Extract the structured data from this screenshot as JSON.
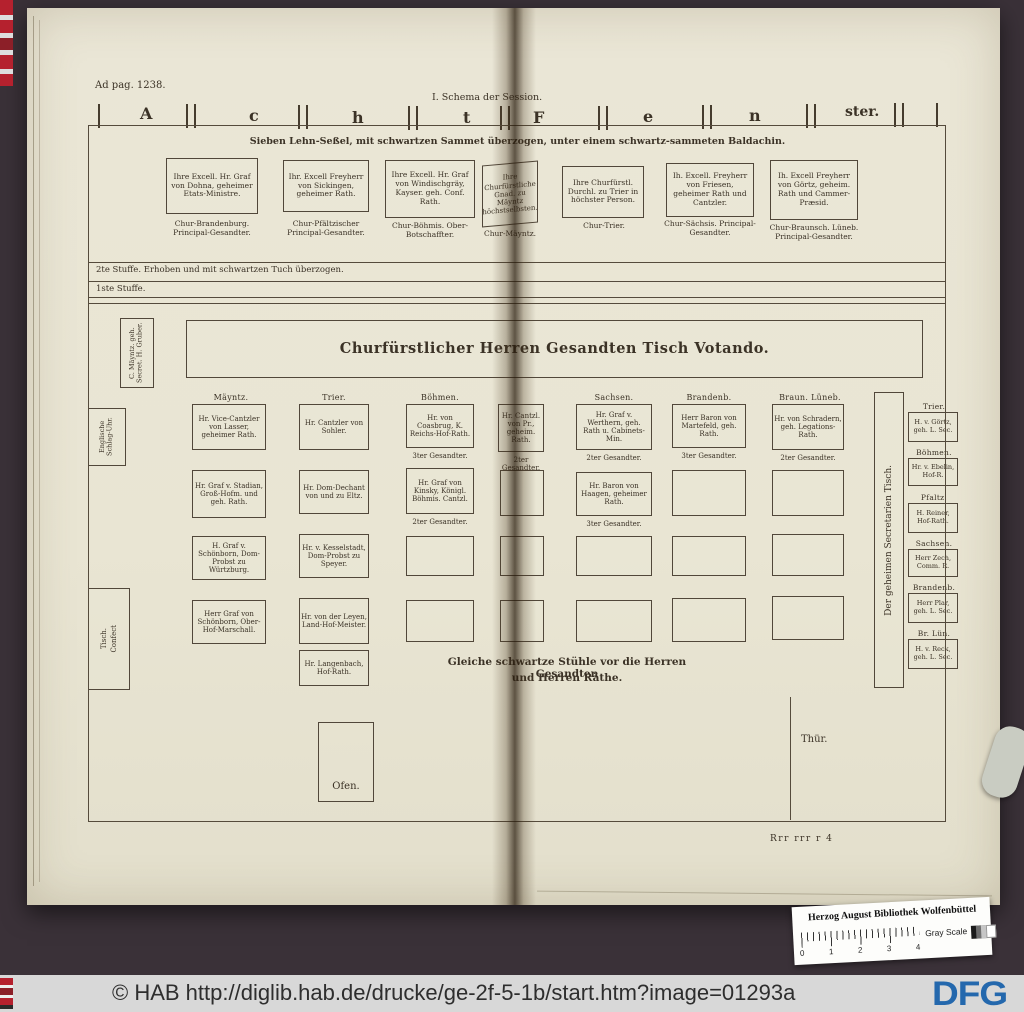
{
  "colors": {
    "page_bg": "#e9e5d3",
    "ink": "#3b3226",
    "backdrop": "#3a3138",
    "bar_bg": "#d8d8d8",
    "dfg_blue": "#2468ad",
    "strip_red": "#b5212e"
  },
  "scan": {
    "ad_pag": "Ad pag. 1238.",
    "schema_label": "I. Schema der Session.",
    "window_letters": [
      "A",
      "c",
      "h",
      "t",
      "F",
      "e",
      "n",
      "ster."
    ],
    "baldachin_caption": "Sieben Lehn-Seßel, mit schwartzen Sammet überzogen, unter einem schwartz-sammeten Baldachin.",
    "chairs": [
      {
        "box": "Ihre Excell. Hr. Graf von Dohna, geheimer Etats-Ministre.",
        "caption": "Chur-Brandenburg. Principal-Gesandter."
      },
      {
        "box": "Ihr. Excell Freyherr von Sickingen, geheimer Rath.",
        "caption": "Chur-Pfältzischer Principal-Gesandter."
      },
      {
        "box": "Ihre Excell. Hr. Graf von Windischgräy, Kayser. geh. Conf. Rath.",
        "caption": "Chur-Böhmis. Ober-Botschaffter."
      },
      {
        "box": "Ihre Churfürstliche Gnad. zu Mäyntz höchstselbsten.",
        "caption": "Chur-Mäyntz."
      },
      {
        "box": "Ihre Churfürstl. Durchl. zu Trier in höchster Person.",
        "caption": "Chur-Trier."
      },
      {
        "box": "Ih. Excell. Freyherr von Friesen, geheimer Rath und Cantzler.",
        "caption": "Chur-Sächsis. Principal-Gesandter."
      },
      {
        "box": "Ih. Excell Freyherr von Görtz, geheim. Rath und Cammer-Præsid.",
        "caption": "Chur-Braunsch. Lüneb. Principal-Gesandter."
      }
    ],
    "steps": {
      "step2": "2te Stuffe. Erhoben und mit schwartzen Tuch überzogen.",
      "step1": "1ste Stuffe."
    },
    "left_secretary": "C. Mäyntz. geh. Secret. H. Gruber.",
    "table_title": "Churfürstlicher Herren Gesandten Tisch Votando.",
    "clock": "Englische Schlag-Uhr.",
    "columns": {
      "mayntz": "Mäyntz.",
      "trier": "Trier.",
      "boehmen": "Böhmen.",
      "sachsen": "Sachsen.",
      "brandenb": "Brandenb.",
      "braun": "Braun. Lüneb."
    },
    "seats": {
      "m1": {
        "text": "Hr. Vice-Cantzler von Lasser, geheimer Rath."
      },
      "m2": {
        "text": "Hr. Graf v. Stadian, Groß-Hofm. und geh. Rath."
      },
      "m3": {
        "text": "H. Graf v. Schönborn, Dom-Probst zu Würtzburg."
      },
      "m4": {
        "text": "Herr Graf von Schönborn, Ober-Hof-Marschall."
      },
      "t1": {
        "text": "Hr. Cantzler von Sohler."
      },
      "t2": {
        "text": "Hr. Dom-Dechant von und zu Eltz."
      },
      "t3": {
        "text": "Hr. v. Kesselstadt, Dom-Probst zu Speyer."
      },
      "t4": {
        "text": "Hr. von der Leyen, Land-Hof-Meister."
      },
      "t5": {
        "text": "Hr. Langenbach, Hof-Rath."
      },
      "b1": {
        "text": "Hr. von Coasbrug, K. Reichs-Hof-Rath.",
        "sub": "3ter Gesandter."
      },
      "b2": {
        "text": "Hr. Graf von Kinsky, Königl. Böhmis. Cantzl.",
        "sub": "2ter Gesandter."
      },
      "f1": {
        "text": "Hr. Cantzl. von Pr., geheim. Rath.",
        "sub": "2ter Gesandter."
      },
      "s1": {
        "text": "Hr. Graf v. Werthern, geh. Rath u. Cabinets-Min.",
        "sub": "2ter Gesandter."
      },
      "s2": {
        "text": "Hr. Baron von Haagen, geheimer Rath.",
        "sub": "3ter Gesandter."
      },
      "br1": {
        "text": "Herr Baron von Martefeld, geh. Rath.",
        "sub": "3ter Gesandter."
      },
      "bl1": {
        "text": "Hr. von Schradern, geh. Legations-Rath.",
        "sub": "2ter Gesandter."
      }
    },
    "stuehle_caption_1": "Gleiche schwartze Stühle vor die Herren Gesandten",
    "stuehle_caption_2": "und Herren Räthe.",
    "sec_table_label": "Der geheimen Secretarien Tisch.",
    "sec_list": [
      {
        "region": "Trier.",
        "name": "H. v. Görtz, geh. L. Sec."
      },
      {
        "region": "Böhmen.",
        "name": "Hr. v. Ebelin, Hof-R."
      },
      {
        "region": "Pfaltz.",
        "name": "H. Reiner, Hof-Rath."
      },
      {
        "region": "Sachsen.",
        "name": "Herr Zech, Comm. R."
      },
      {
        "region": "Brandenb.",
        "name": "Herr Plar, geh. L. Sec."
      },
      {
        "region": "Br. Lün.",
        "name": "H. v. Reck, geh. L. Sec."
      }
    ],
    "confect_1": "Confect",
    "confect_2": "Tisch.",
    "ofen": "Ofen.",
    "thuer": "Thür.",
    "signature": "Rrr rrr r 4"
  },
  "sticker": {
    "title": "Herzog August Bibliothek Wolfenbüttel",
    "gray_scale": "Gray Scale",
    "ruler": [
      "0",
      "1",
      "2",
      "3",
      "4"
    ]
  },
  "bottom_bar": {
    "text": "© HAB http://diglib.hab.de/drucke/ge-2f-5-1b/start.htm?image=01293a",
    "logo": "DFG"
  }
}
